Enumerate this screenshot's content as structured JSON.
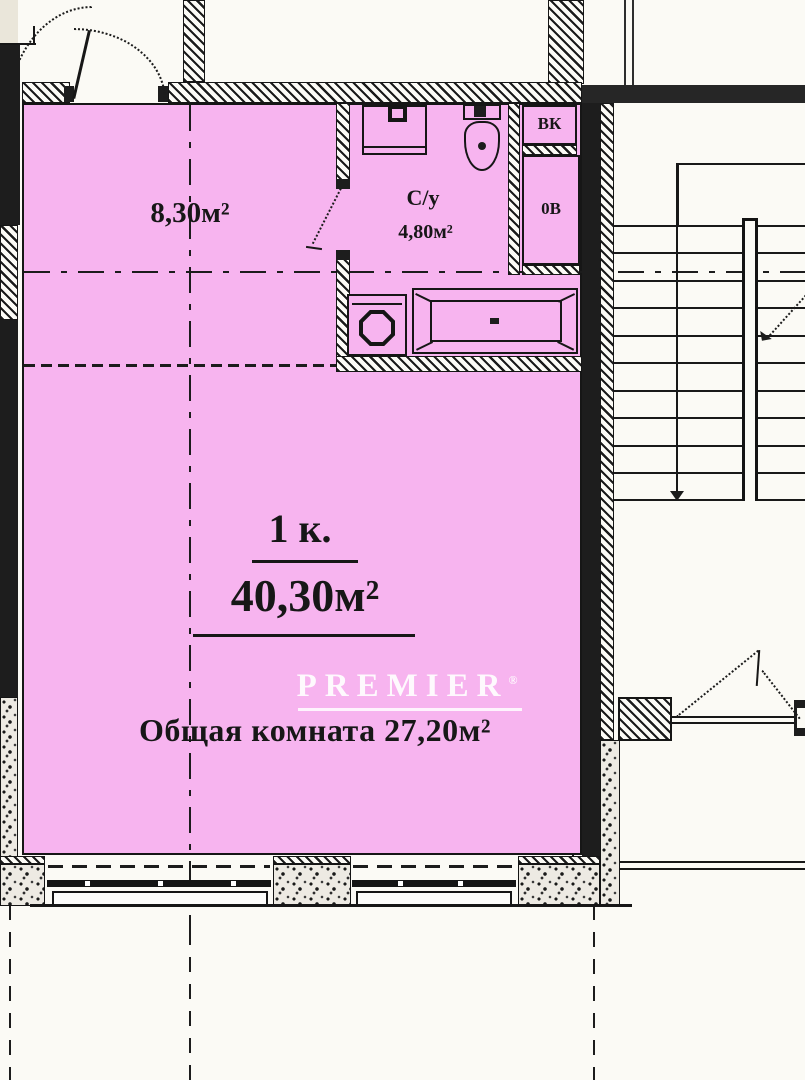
{
  "floorplan": {
    "watermark": {
      "text": "PREMIER",
      "mark": "®"
    },
    "rooms": {
      "hallway": {
        "area": "8,30м²"
      },
      "bathroom": {
        "name": "С/у",
        "area": "4,80м²"
      },
      "living": {
        "type": "1 к.",
        "total_area": "40,30м²",
        "caption": "Общая комната 27,20м²"
      }
    },
    "shafts": {
      "vk": "ВК",
      "ov": "0В"
    },
    "colors": {
      "room_fill": "#f7b4ef",
      "wall": "#1d1d1d",
      "watermark": "#ffffff"
    }
  }
}
